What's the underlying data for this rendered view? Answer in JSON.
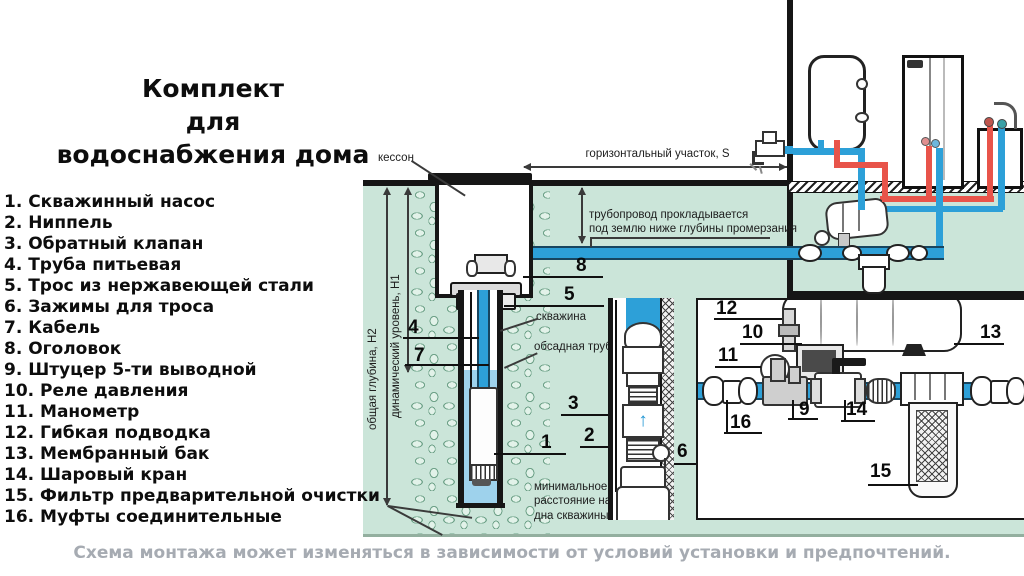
{
  "title": {
    "line1": "Комплект",
    "line2": "для",
    "line3": "водоснабжения дома"
  },
  "parts_list": [
    "1. Скважинный насос",
    "2. Ниппель",
    "3. Обратный клапан",
    "4. Труба питьевая",
    "5. Трос из нержавеющей стали",
    "6. Зажимы для троса",
    "7. Кабель",
    "8. Оголовок",
    "9. Штуцер 5-ти выводной",
    "10. Реле давления",
    "11. Манометр",
    "12. Гибкая подводка",
    "13. Мембранный бак",
    "14. Шаровый кран",
    "15. Фильтр предварительной очистки",
    "16. Муфты соединительные"
  ],
  "diagram": {
    "labels": {
      "kesson": "кессон",
      "horizontal_section": "горизонтальный участок, S",
      "pipeline_note_line1": "трубопровод прокладывается",
      "pipeline_note_line2": "под землю ниже глубины промерзания",
      "total_depth": "общая глубина, Н2",
      "dynamic_level": "динамический уровень, Н1",
      "borehole": "скважина",
      "casing_pipe": "обсадная труба",
      "min_distance": "минимальное расстояние насоса от дна скважины 1м",
      "valve_arrow": "↑"
    },
    "callouts": {
      "c1": "1",
      "c2": "2",
      "c3": "3",
      "c4": "4",
      "c5": "5",
      "c6": "6",
      "c7": "7",
      "c8": "8",
      "c9": "9",
      "c10": "10",
      "c11": "11",
      "c12": "12",
      "c13": "13",
      "c14": "14",
      "c15": "15",
      "c16": "16"
    }
  },
  "footer": {
    "note": "Схема монтажа может изменяться в зависимости от условий установки и предпочтений."
  },
  "colors": {
    "ground": "#cbe5d9",
    "pipe_blue": "#2da0d8",
    "pipe_red": "#e8544a",
    "well_water": "#9ed2ec",
    "note_gray": "#a6abb2"
  }
}
